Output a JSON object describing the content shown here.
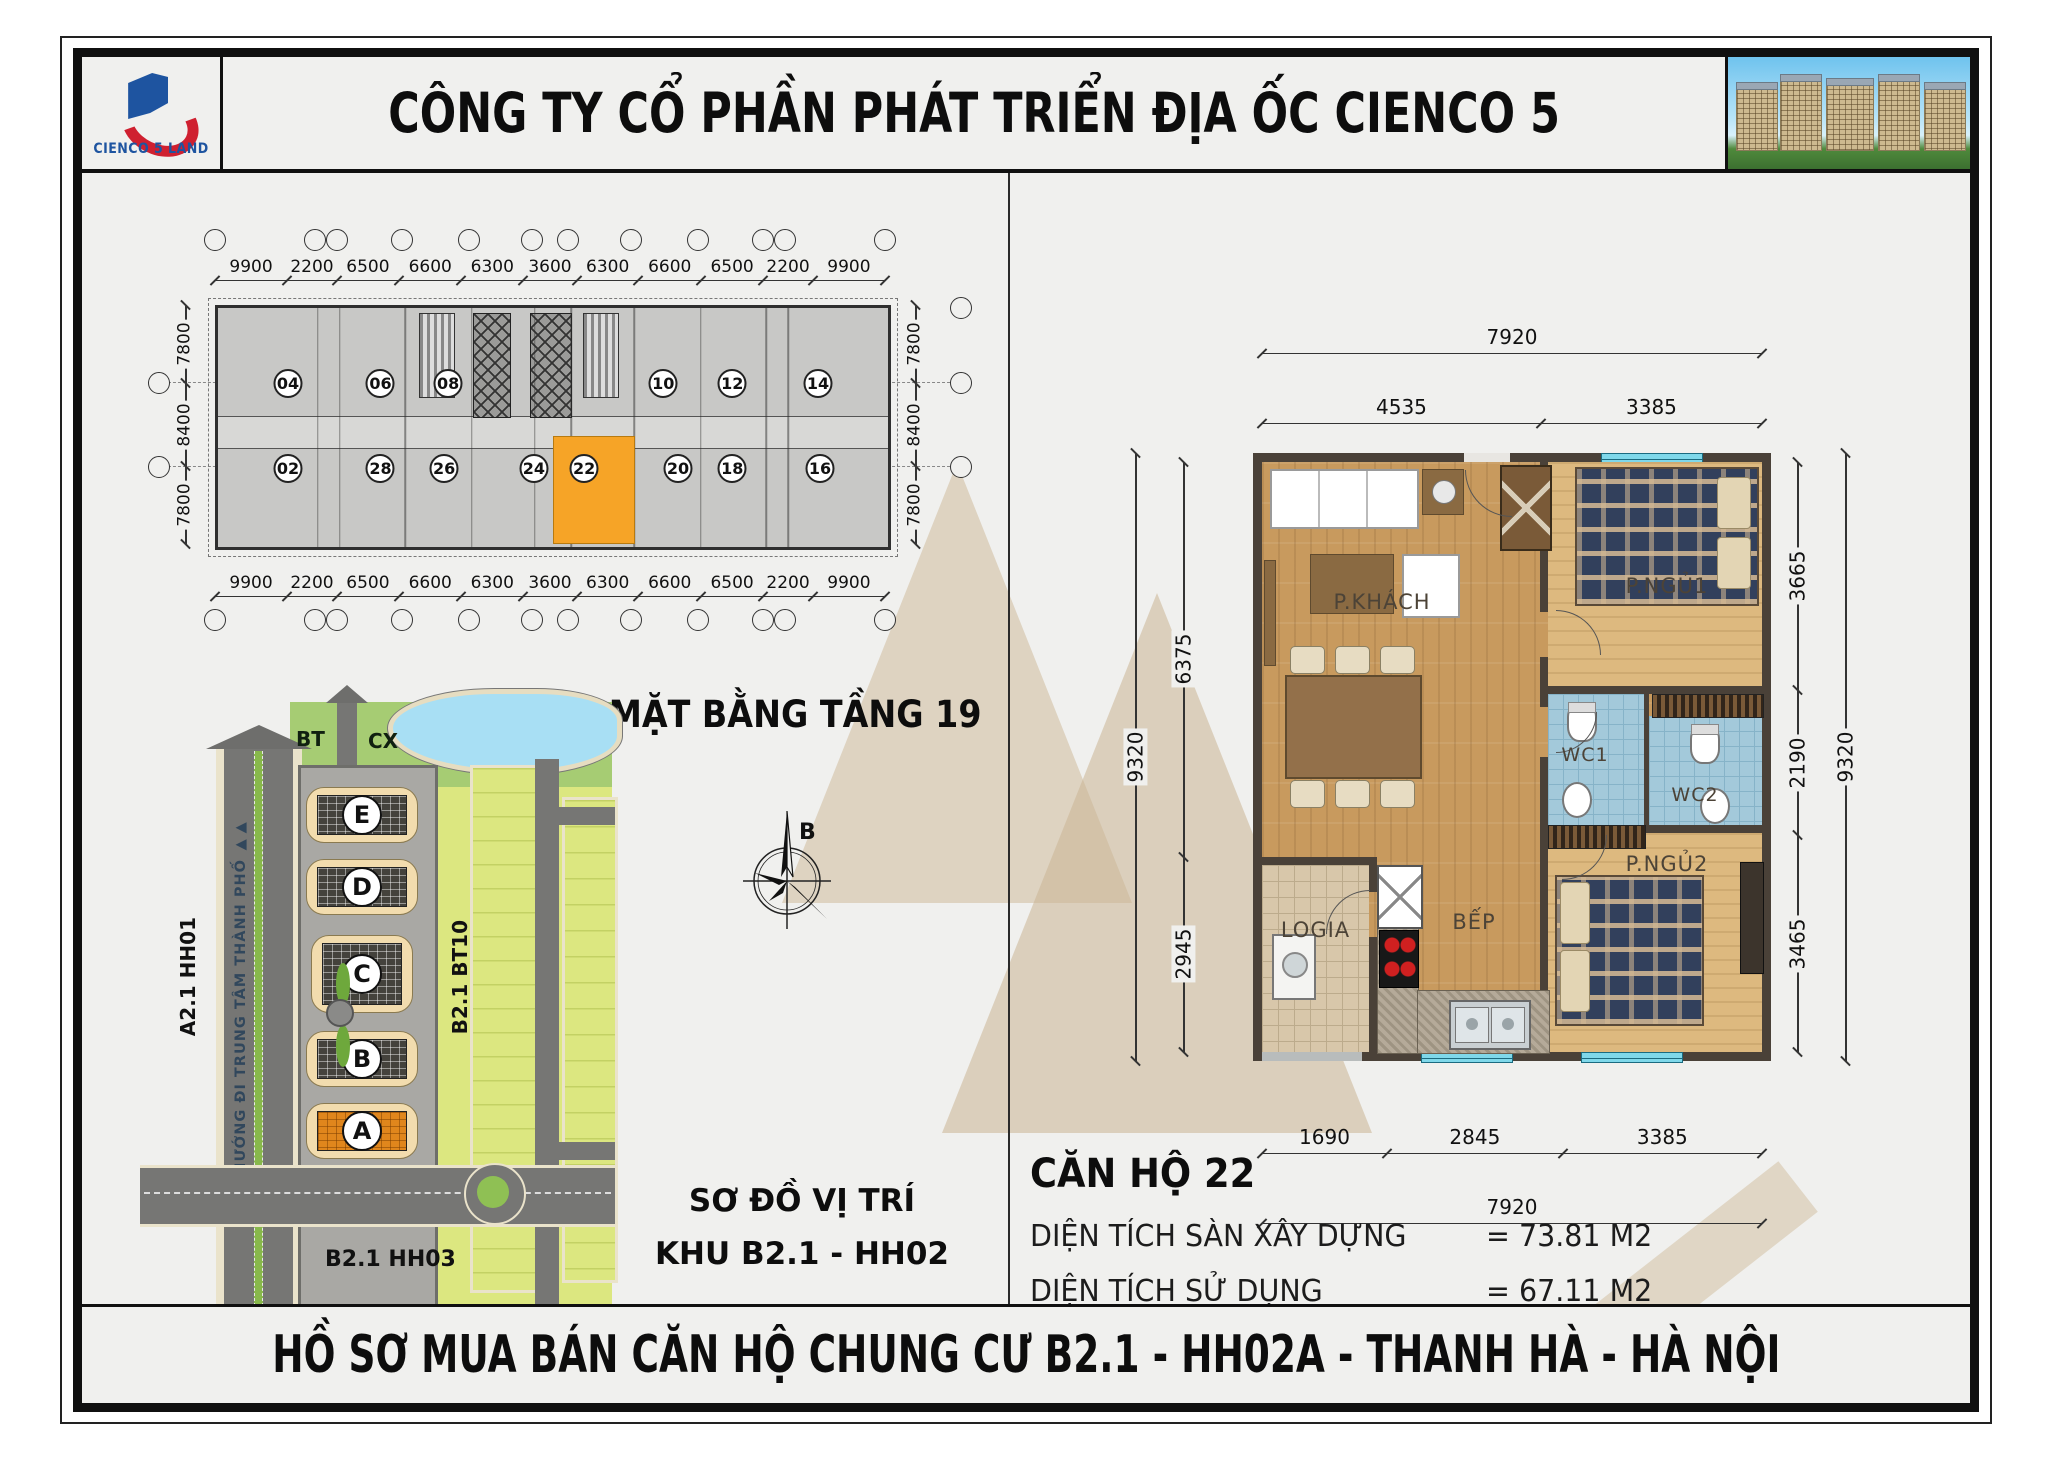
{
  "header": {
    "logo_text": "CIENCO 5 LAND",
    "title": "CÔNG TY CỔ PHẦN PHÁT TRIỂN ĐỊA ỐC CIENCO 5"
  },
  "overview": {
    "title": "MẶT BẰNG TẦNG 19",
    "compass_label": "B",
    "top_dims": [
      "9900",
      "2200",
      "6500",
      "6600",
      "6300",
      "3600",
      "6300",
      "6600",
      "6500",
      "2200",
      "9900"
    ],
    "bottom_dims": [
      "9900",
      "2200",
      "6500",
      "6600",
      "6300",
      "3600",
      "6300",
      "6600",
      "6500",
      "2200",
      "9900"
    ],
    "left_dims": [
      "7800",
      "8400",
      "7800"
    ],
    "right_dims": [
      "7800",
      "8400",
      "7800"
    ],
    "units_top": [
      "04",
      "06",
      "08",
      "10",
      "12",
      "14"
    ],
    "units_bottom": [
      "02",
      "28",
      "26",
      "24",
      "22",
      "20",
      "18",
      "16"
    ],
    "highlight_unit": "22"
  },
  "siteplan": {
    "labels": {
      "bt": "BT",
      "cx": "CX",
      "left_parcel": "A2.1 HH01",
      "right_parcel": "B2.1 BT10",
      "bottom_parcel": "B2.1 HH03",
      "road": "HƯỚNG ĐI TRUNG TÂM THÀNH PHỐ ▶▶"
    },
    "buildings": [
      "E",
      "D",
      "C",
      "B",
      "A"
    ],
    "highlight_building": "A",
    "caption_line1": "SƠ ĐỒ VỊ TRÍ",
    "caption_line2": "KHU B2.1 - HH02"
  },
  "apartment": {
    "rooms": {
      "living": "P.KHÁCH",
      "bedroom1": "P.NGỦ1",
      "wc1": "WC1",
      "wc2": "WC2",
      "bedroom2": "P.NGỦ2",
      "kitchen": "BẾP",
      "loggia": "LOGIA"
    },
    "dims": {
      "top_overall": [
        "7920"
      ],
      "top_segments": [
        "4535",
        "3385"
      ],
      "bottom_segments": [
        "1690",
        "2845",
        "3385"
      ],
      "bottom_overall": [
        "7920"
      ],
      "left_overall": [
        "9320"
      ],
      "left_segments": [
        "6375",
        "2945"
      ],
      "right_segments": [
        "3665",
        "2190",
        "3465"
      ],
      "right_overall": [
        "9320"
      ]
    }
  },
  "unit_info": {
    "title": "CĂN HỘ 22",
    "rows": [
      {
        "label": "DIỆN TÍCH SÀN XÂY DỰNG",
        "value": "= 73.81 M2"
      },
      {
        "label": "DIỆN TÍCH SỬ DỤNG",
        "value": "= 67.11 M2"
      }
    ]
  },
  "footer": {
    "title": "HỒ SƠ MUA BÁN CĂN HỘ CHUNG CƯ B2.1 - HH02A - THANH HÀ - HÀ NỘI"
  },
  "colors": {
    "highlight_orange": "#F6A427",
    "logo_blue": "#1E54A0",
    "logo_red": "#CF2030",
    "water_blue": "#A8DFF4",
    "land_green": "#DCE780",
    "road_gray": "#767674",
    "window_cyan": "#7FD8EA"
  }
}
